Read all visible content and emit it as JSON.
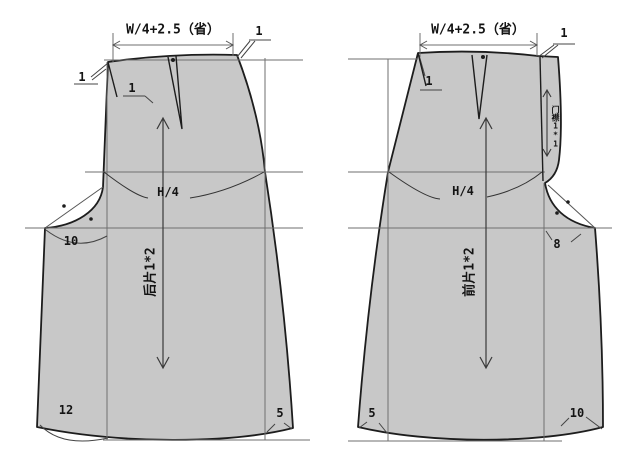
{
  "colors": {
    "piece_fill": "#c8c8c8",
    "outline": "#1d1d1d",
    "guide": "#6f6f6f"
  },
  "back_piece": {
    "name_label": "后片1*2",
    "waist_dimension": "W/4+2.5（省）",
    "hip_line_label": "H/4",
    "allowance_top_right": "1",
    "allowance_top_left_outer": "1",
    "allowance_top_left_inner": "1",
    "crotch_extension": "10",
    "hem_left": "12",
    "hem_right": "5"
  },
  "front_piece": {
    "name_label": "前片1*2",
    "waist_dimension": "W/4+2.5（省）",
    "hip_line_label": "H/4",
    "allowance_top_right": "1",
    "allowance_top_left": "1",
    "placket_label": "门襟1*1",
    "crotch_extension": "8",
    "hem_left": "5",
    "hem_right": "10"
  }
}
